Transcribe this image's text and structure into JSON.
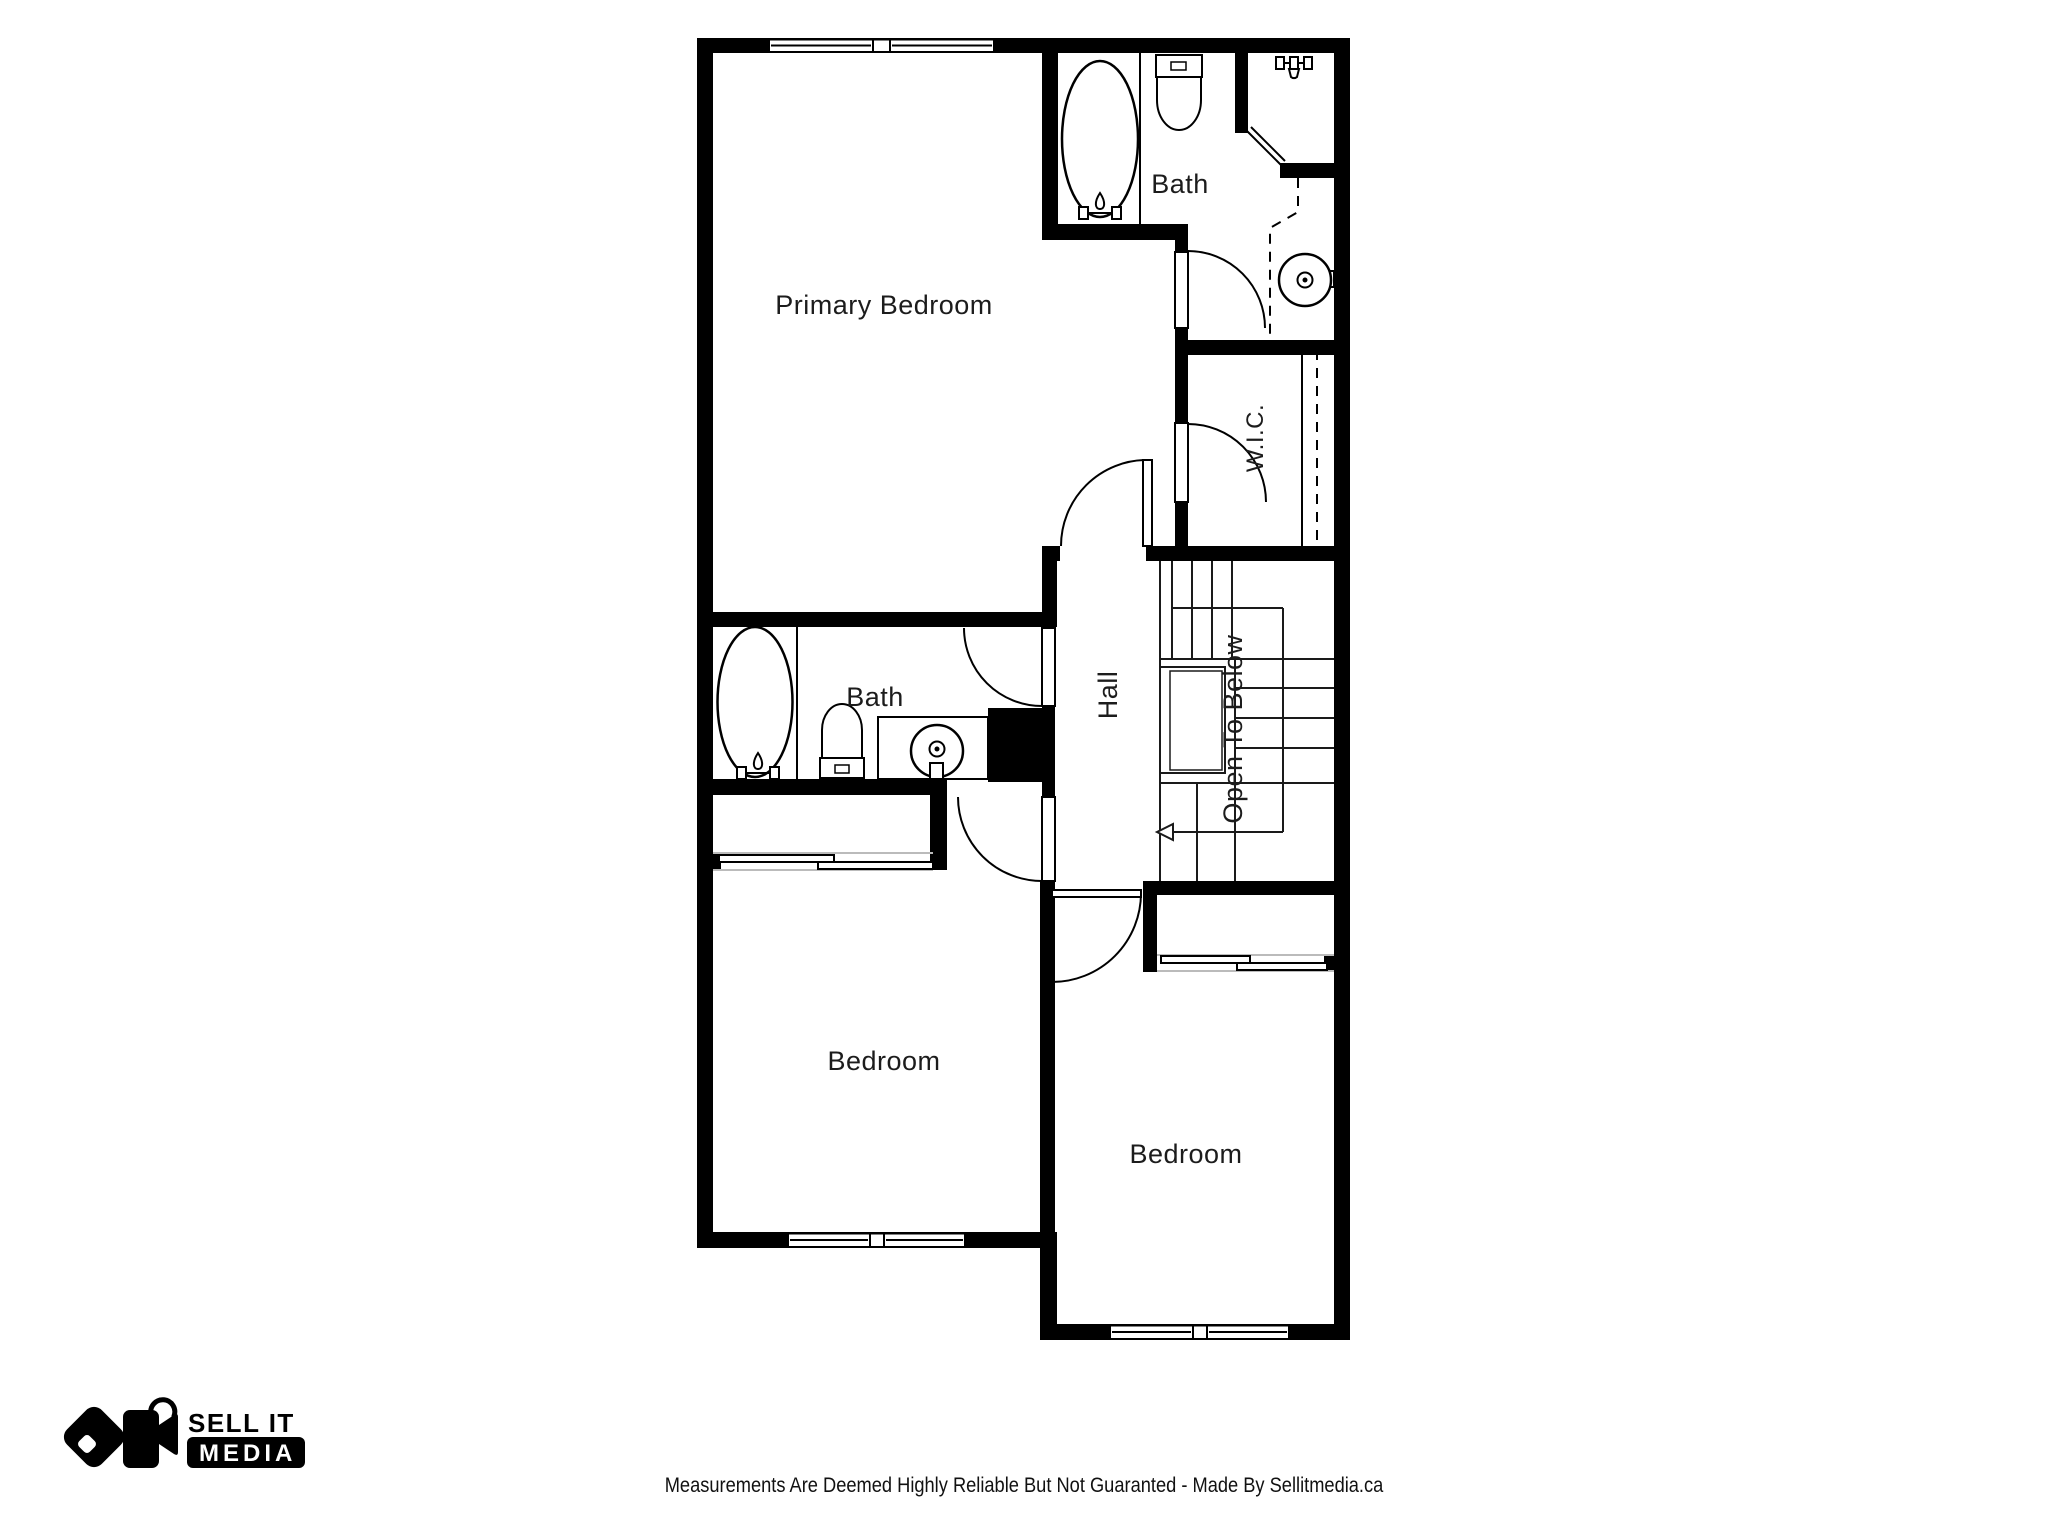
{
  "colors": {
    "wall": "#000000",
    "ink": "#1c1c1c",
    "background": "#ffffff",
    "closet_track": "#bbbbbb"
  },
  "floorplan": {
    "rooms": [
      {
        "id": "primary-bedroom",
        "label": "Primary Bedroom"
      },
      {
        "id": "ensuite-bath",
        "label": "Bath"
      },
      {
        "id": "walk-in-closet",
        "label": "W.I.C."
      },
      {
        "id": "hall",
        "label": "Hall"
      },
      {
        "id": "open-to-below",
        "label": "Open To Below"
      },
      {
        "id": "main-bath",
        "label": "Bath"
      },
      {
        "id": "bedroom-left",
        "label": "Bedroom"
      },
      {
        "id": "bedroom-right",
        "label": "Bedroom"
      }
    ],
    "fixtures": [
      "bathtub-icon",
      "toilet-icon",
      "shower-head-icon",
      "pedestal-sink-icon",
      "bathtub-icon",
      "toilet-icon",
      "vanity-sink-icon",
      "sliding-closet-doors-icon",
      "sliding-closet-doors-icon",
      "stairs-icon",
      "stair-direction-arrow-icon"
    ]
  },
  "branding": {
    "logo_line1": "SELL IT",
    "logo_line2": "MEDIA"
  },
  "footer": {
    "disclaimer": "Measurements Are Deemed Highly Reliable But Not Guaranted - Made By Sellitmedia.ca"
  }
}
